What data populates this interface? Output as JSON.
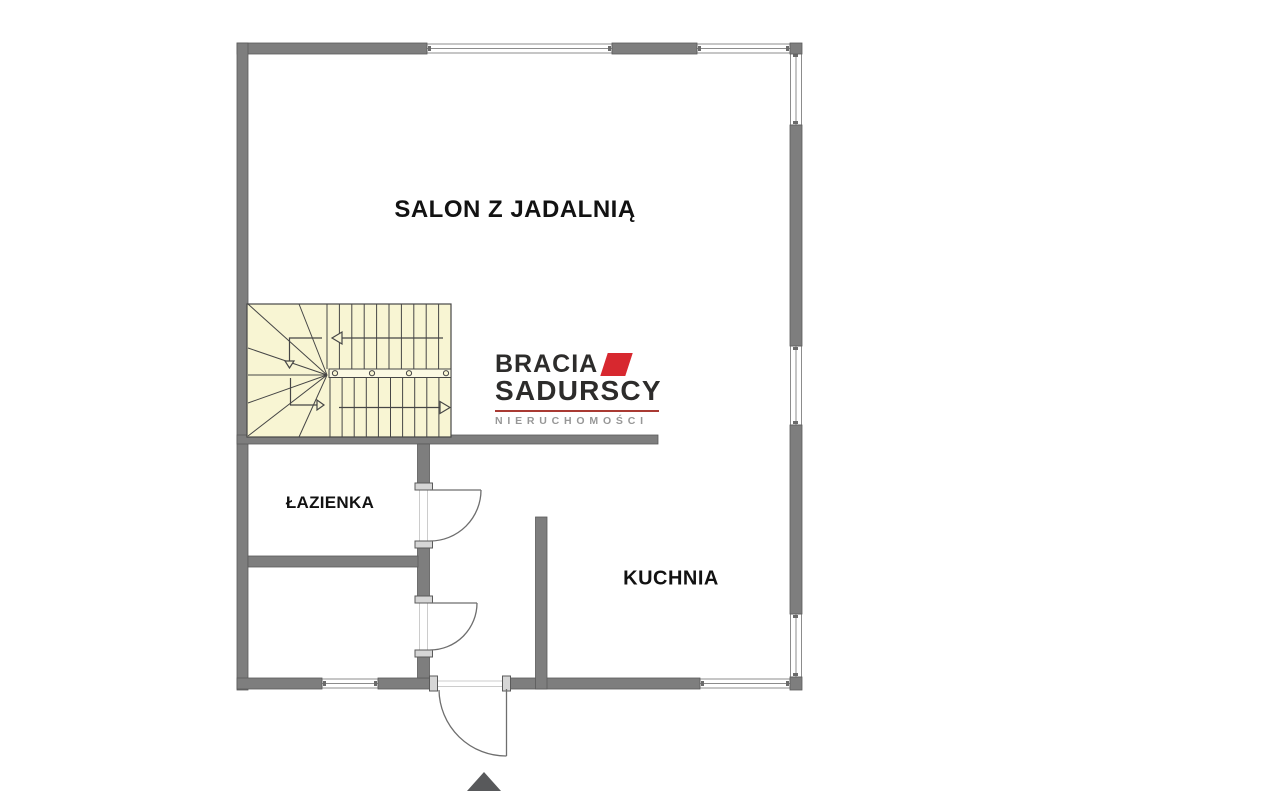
{
  "rooms": {
    "salon": {
      "label": "SALON Z JADALNIĄ"
    },
    "lazienka": {
      "label": "ŁAZIENKA"
    },
    "kuchnia": {
      "label": "KUCHNIA"
    }
  },
  "logo": {
    "line1": "BRACIA",
    "line2": "SADURSCY",
    "line3": "NIERUCHOMOŚCI",
    "accent_red": "#d7282f",
    "underline_red": "#a93a33",
    "text_dark": "#2d2c2b",
    "text_gray": "#979797"
  },
  "plan": {
    "colors": {
      "background": "#ffffff",
      "wall_fill": "#7e7e7e",
      "wall_stroke": "#5a5a5a",
      "window_frame": "#8c8c8c",
      "stairs_fill": "#f8f5d3",
      "stairs_line": "#464646",
      "door_line": "#6e6e6e",
      "door_post_fill": "#d6d6d6",
      "entrance_arrow": "#58595b",
      "label_text": "#121212"
    },
    "stairs": {
      "type": "u-shaped-winder",
      "up_flight_arrow": "left",
      "down_flight_arrow": "right"
    },
    "doors": [
      "entrance-door",
      "bathroom-door",
      "lower-room-door"
    ],
    "windows_count": 7,
    "entrance_marker": "up-triangle-arrow"
  }
}
